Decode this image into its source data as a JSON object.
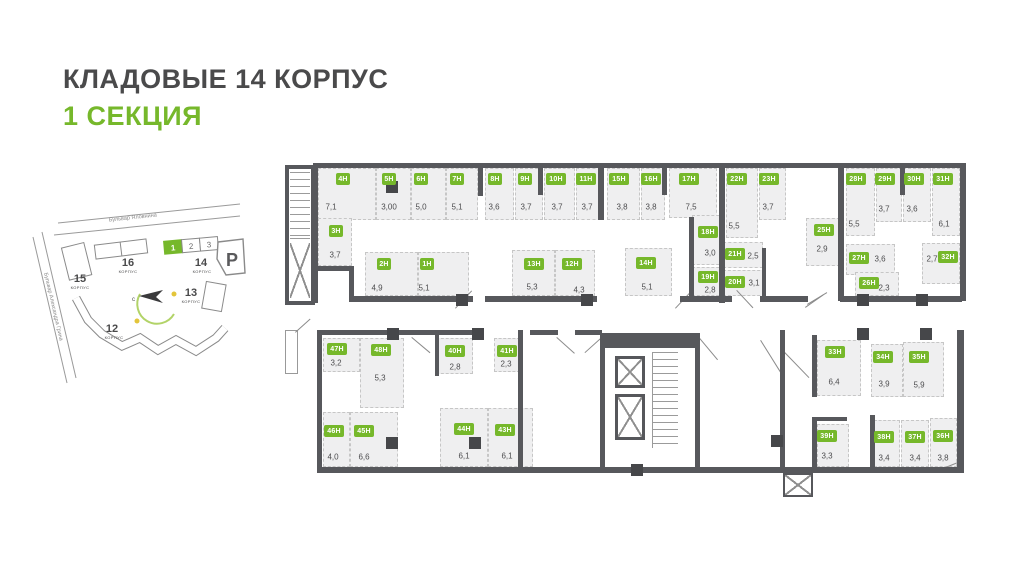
{
  "title": {
    "heading": "КЛАДОВЫЕ 14 КОРПУС",
    "subheading": "1 СЕКЦИЯ"
  },
  "colors": {
    "accent_green": "#76b82b",
    "heading_gray": "#4a4a4b",
    "wall_gray": "#57585c",
    "room_fill": "#efeff0"
  },
  "minimap": {
    "street_top": "Бульвар Яловнина",
    "street_left": "Бульвар Александра Грина",
    "parking_label": "P",
    "compass_north": "с",
    "buildings": [
      {
        "num": "15",
        "label": "КОРПУС"
      },
      {
        "num": "16",
        "label": "КОРПУС"
      },
      {
        "num": "14",
        "label": "КОРПУС",
        "sections": [
          "1",
          "2",
          "3"
        ],
        "active_section": "1"
      },
      {
        "num": "13",
        "label": "КОРПУС"
      },
      {
        "num": "12",
        "label": "КОРПУС"
      }
    ]
  },
  "plan": {
    "units": [
      {
        "id": "4Н",
        "area": "7,1",
        "x": 33,
        "y": 8,
        "w": 58,
        "h": 52,
        "bx": 58,
        "by": 19,
        "ax": 46,
        "ay": 47
      },
      {
        "id": "5Н",
        "area": "3,00",
        "x": 91,
        "y": 8,
        "w": 35,
        "h": 52,
        "bx": 104,
        "by": 19,
        "ax": 104,
        "ay": 47
      },
      {
        "id": "6Н",
        "area": "5,0",
        "x": 126,
        "y": 8,
        "w": 35,
        "h": 52,
        "bx": 136,
        "by": 19,
        "ax": 136,
        "ay": 47
      },
      {
        "id": "7Н",
        "area": "5,1",
        "x": 161,
        "y": 8,
        "w": 32,
        "h": 52,
        "bx": 172,
        "by": 19,
        "ax": 172,
        "ay": 47
      },
      {
        "id": "8Н",
        "area": "3,6",
        "x": 200,
        "y": 8,
        "w": 29,
        "h": 52,
        "bx": 210,
        "by": 19,
        "ax": 209,
        "ay": 47
      },
      {
        "id": "9Н",
        "area": "3,7",
        "x": 230,
        "y": 8,
        "w": 28,
        "h": 52,
        "bx": 240,
        "by": 19,
        "ax": 241,
        "ay": 47
      },
      {
        "id": "10Н",
        "area": "3,7",
        "x": 259,
        "y": 8,
        "w": 31,
        "h": 52,
        "bx": 271,
        "by": 19,
        "ax": 272,
        "ay": 47
      },
      {
        "id": "11Н",
        "area": "3,7",
        "x": 291,
        "y": 8,
        "w": 25,
        "h": 52,
        "bx": 301,
        "by": 19,
        "ax": 302,
        "ay": 47
      },
      {
        "id": "15Н",
        "area": "3,8",
        "x": 322,
        "y": 8,
        "w": 33,
        "h": 52,
        "bx": 334,
        "by": 19,
        "ax": 337,
        "ay": 47
      },
      {
        "id": "16Н",
        "area": "3,8",
        "x": 356,
        "y": 8,
        "w": 24,
        "h": 52,
        "bx": 366,
        "by": 19,
        "ax": 366,
        "ay": 47
      },
      {
        "id": "17Н",
        "area": "7,5",
        "x": 384,
        "y": 8,
        "w": 48,
        "h": 50,
        "bx": 404,
        "by": 19,
        "ax": 406,
        "ay": 47
      },
      {
        "id": "22Н",
        "area": "5,5",
        "x": 441,
        "y": 8,
        "w": 32,
        "h": 70,
        "bx": 452,
        "by": 19,
        "ax": 449,
        "ay": 66
      },
      {
        "id": "23Н",
        "area": "3,7",
        "x": 474,
        "y": 8,
        "w": 27,
        "h": 52,
        "bx": 484,
        "by": 19,
        "ax": 483,
        "ay": 47
      },
      {
        "id": "28Н",
        "area": "5,5",
        "x": 561,
        "y": 8,
        "w": 29,
        "h": 68,
        "bx": 571,
        "by": 19,
        "ax": 569,
        "ay": 64
      },
      {
        "id": "29Н",
        "area": "3,7",
        "x": 591,
        "y": 8,
        "w": 26,
        "h": 54,
        "bx": 600,
        "by": 19,
        "ax": 599,
        "ay": 49
      },
      {
        "id": "30Н",
        "area": "3,6",
        "x": 618,
        "y": 8,
        "w": 28,
        "h": 54,
        "bx": 629,
        "by": 19,
        "ax": 627,
        "ay": 49
      },
      {
        "id": "31Н",
        "area": "6,1",
        "x": 647,
        "y": 8,
        "w": 28,
        "h": 68,
        "bx": 658,
        "by": 19,
        "ax": 659,
        "ay": 64
      },
      {
        "id": "3Н",
        "area": "3,7",
        "x": 33,
        "y": 58,
        "w": 34,
        "h": 48,
        "bx": 51,
        "by": 71,
        "ax": 50,
        "ay": 95
      },
      {
        "id": "2Н",
        "area": "4,9",
        "x": 80,
        "y": 92,
        "w": 53,
        "h": 44,
        "bx": 99,
        "by": 104,
        "ax": 92,
        "ay": 128
      },
      {
        "id": "1Н",
        "area": "5,1",
        "x": 133,
        "y": 92,
        "w": 51,
        "h": 44,
        "bx": 142,
        "by": 104,
        "ax": 139,
        "ay": 128
      },
      {
        "id": "13Н",
        "area": "5,3",
        "x": 227,
        "y": 90,
        "w": 43,
        "h": 46,
        "bx": 249,
        "by": 104,
        "ax": 247,
        "ay": 127
      },
      {
        "id": "12Н",
        "area": "4,3",
        "x": 270,
        "y": 90,
        "w": 40,
        "h": 46,
        "bx": 287,
        "by": 104,
        "ax": 294,
        "ay": 130
      },
      {
        "id": "14Н",
        "area": "5,1",
        "x": 340,
        "y": 88,
        "w": 47,
        "h": 48,
        "bx": 361,
        "by": 103,
        "ax": 362,
        "ay": 127
      },
      {
        "id": "18Н",
        "area": "3,0",
        "x": 407,
        "y": 55,
        "w": 32,
        "h": 50,
        "bx": 423,
        "by": 72,
        "ax": 425,
        "ay": 93
      },
      {
        "id": "19Н",
        "area": "2,8",
        "x": 407,
        "y": 107,
        "w": 32,
        "h": 29,
        "bx": 423,
        "by": 117,
        "ax": 425,
        "ay": 130
      },
      {
        "id": "21Н",
        "area": "2,5",
        "x": 438,
        "y": 82,
        "w": 40,
        "h": 26,
        "bx": 450,
        "by": 94,
        "ax": 468,
        "ay": 96
      },
      {
        "id": "20Н",
        "area": "3,1",
        "x": 438,
        "y": 110,
        "w": 42,
        "h": 26,
        "bx": 450,
        "by": 122,
        "ax": 469,
        "ay": 123
      },
      {
        "id": "25Н",
        "area": "2,9",
        "x": 521,
        "y": 58,
        "w": 34,
        "h": 48,
        "bx": 539,
        "by": 70,
        "ax": 537,
        "ay": 89
      },
      {
        "id": "27Н",
        "area": "3,6",
        "x": 561,
        "y": 84,
        "w": 49,
        "h": 31,
        "bx": 574,
        "by": 98,
        "ax": 595,
        "ay": 99
      },
      {
        "id": "32Н",
        "area": "2,7",
        "x": 637,
        "y": 83,
        "w": 38,
        "h": 41,
        "bx": 663,
        "by": 97,
        "ax": 647,
        "ay": 99
      },
      {
        "id": "26Н",
        "area": "2,3",
        "x": 570,
        "y": 112,
        "w": 44,
        "h": 24,
        "bx": 584,
        "by": 123,
        "ax": 599,
        "ay": 128
      },
      {
        "id": "47Н",
        "area": "3,2",
        "x": 38,
        "y": 178,
        "w": 37,
        "h": 34,
        "bx": 52,
        "by": 189,
        "ax": 51,
        "ay": 203
      },
      {
        "id": "48Н",
        "area": "5,3",
        "x": 75,
        "y": 178,
        "w": 44,
        "h": 70,
        "bx": 96,
        "by": 190,
        "ax": 95,
        "ay": 218
      },
      {
        "id": "40Н",
        "area": "2,8",
        "x": 151,
        "y": 178,
        "w": 37,
        "h": 36,
        "bx": 170,
        "by": 191,
        "ax": 170,
        "ay": 207
      },
      {
        "id": "41Н",
        "area": "2,3",
        "x": 209,
        "y": 178,
        "w": 26,
        "h": 34,
        "bx": 222,
        "by": 191,
        "ax": 221,
        "ay": 204
      },
      {
        "id": "46Н",
        "area": "4,0",
        "x": 38,
        "y": 252,
        "w": 27,
        "h": 55,
        "bx": 49,
        "by": 271,
        "ax": 48,
        "ay": 297
      },
      {
        "id": "45Н",
        "area": "6,6",
        "x": 65,
        "y": 252,
        "w": 48,
        "h": 55,
        "bx": 79,
        "by": 271,
        "ax": 79,
        "ay": 297
      },
      {
        "id": "44Н",
        "area": "6,1",
        "x": 155,
        "y": 248,
        "w": 48,
        "h": 59,
        "bx": 179,
        "by": 269,
        "ax": 179,
        "ay": 296
      },
      {
        "id": "43Н",
        "area": "6,1",
        "x": 203,
        "y": 248,
        "w": 45,
        "h": 59,
        "bx": 220,
        "by": 270,
        "ax": 222,
        "ay": 296
      },
      {
        "id": "33Н",
        "area": "6,4",
        "x": 532,
        "y": 180,
        "w": 44,
        "h": 56,
        "bx": 550,
        "by": 192,
        "ax": 549,
        "ay": 222
      },
      {
        "id": "34Н",
        "area": "3,9",
        "x": 586,
        "y": 184,
        "w": 32,
        "h": 53,
        "bx": 598,
        "by": 197,
        "ax": 599,
        "ay": 224
      },
      {
        "id": "35Н",
        "area": "5,9",
        "x": 618,
        "y": 182,
        "w": 41,
        "h": 55,
        "bx": 634,
        "by": 197,
        "ax": 634,
        "ay": 225
      },
      {
        "id": "39Н",
        "area": "3,3",
        "x": 532,
        "y": 264,
        "w": 32,
        "h": 43,
        "bx": 542,
        "by": 276,
        "ax": 542,
        "ay": 296
      },
      {
        "id": "38Н",
        "area": "3,4",
        "x": 589,
        "y": 260,
        "w": 26,
        "h": 47,
        "bx": 599,
        "by": 277,
        "ax": 599,
        "ay": 298
      },
      {
        "id": "37Н",
        "area": "3,4",
        "x": 616,
        "y": 260,
        "w": 28,
        "h": 47,
        "bx": 630,
        "by": 277,
        "ax": 630,
        "ay": 298
      },
      {
        "id": "36Н",
        "area": "3,8",
        "x": 645,
        "y": 258,
        "w": 27,
        "h": 49,
        "bx": 658,
        "by": 276,
        "ax": 658,
        "ay": 298
      }
    ]
  }
}
